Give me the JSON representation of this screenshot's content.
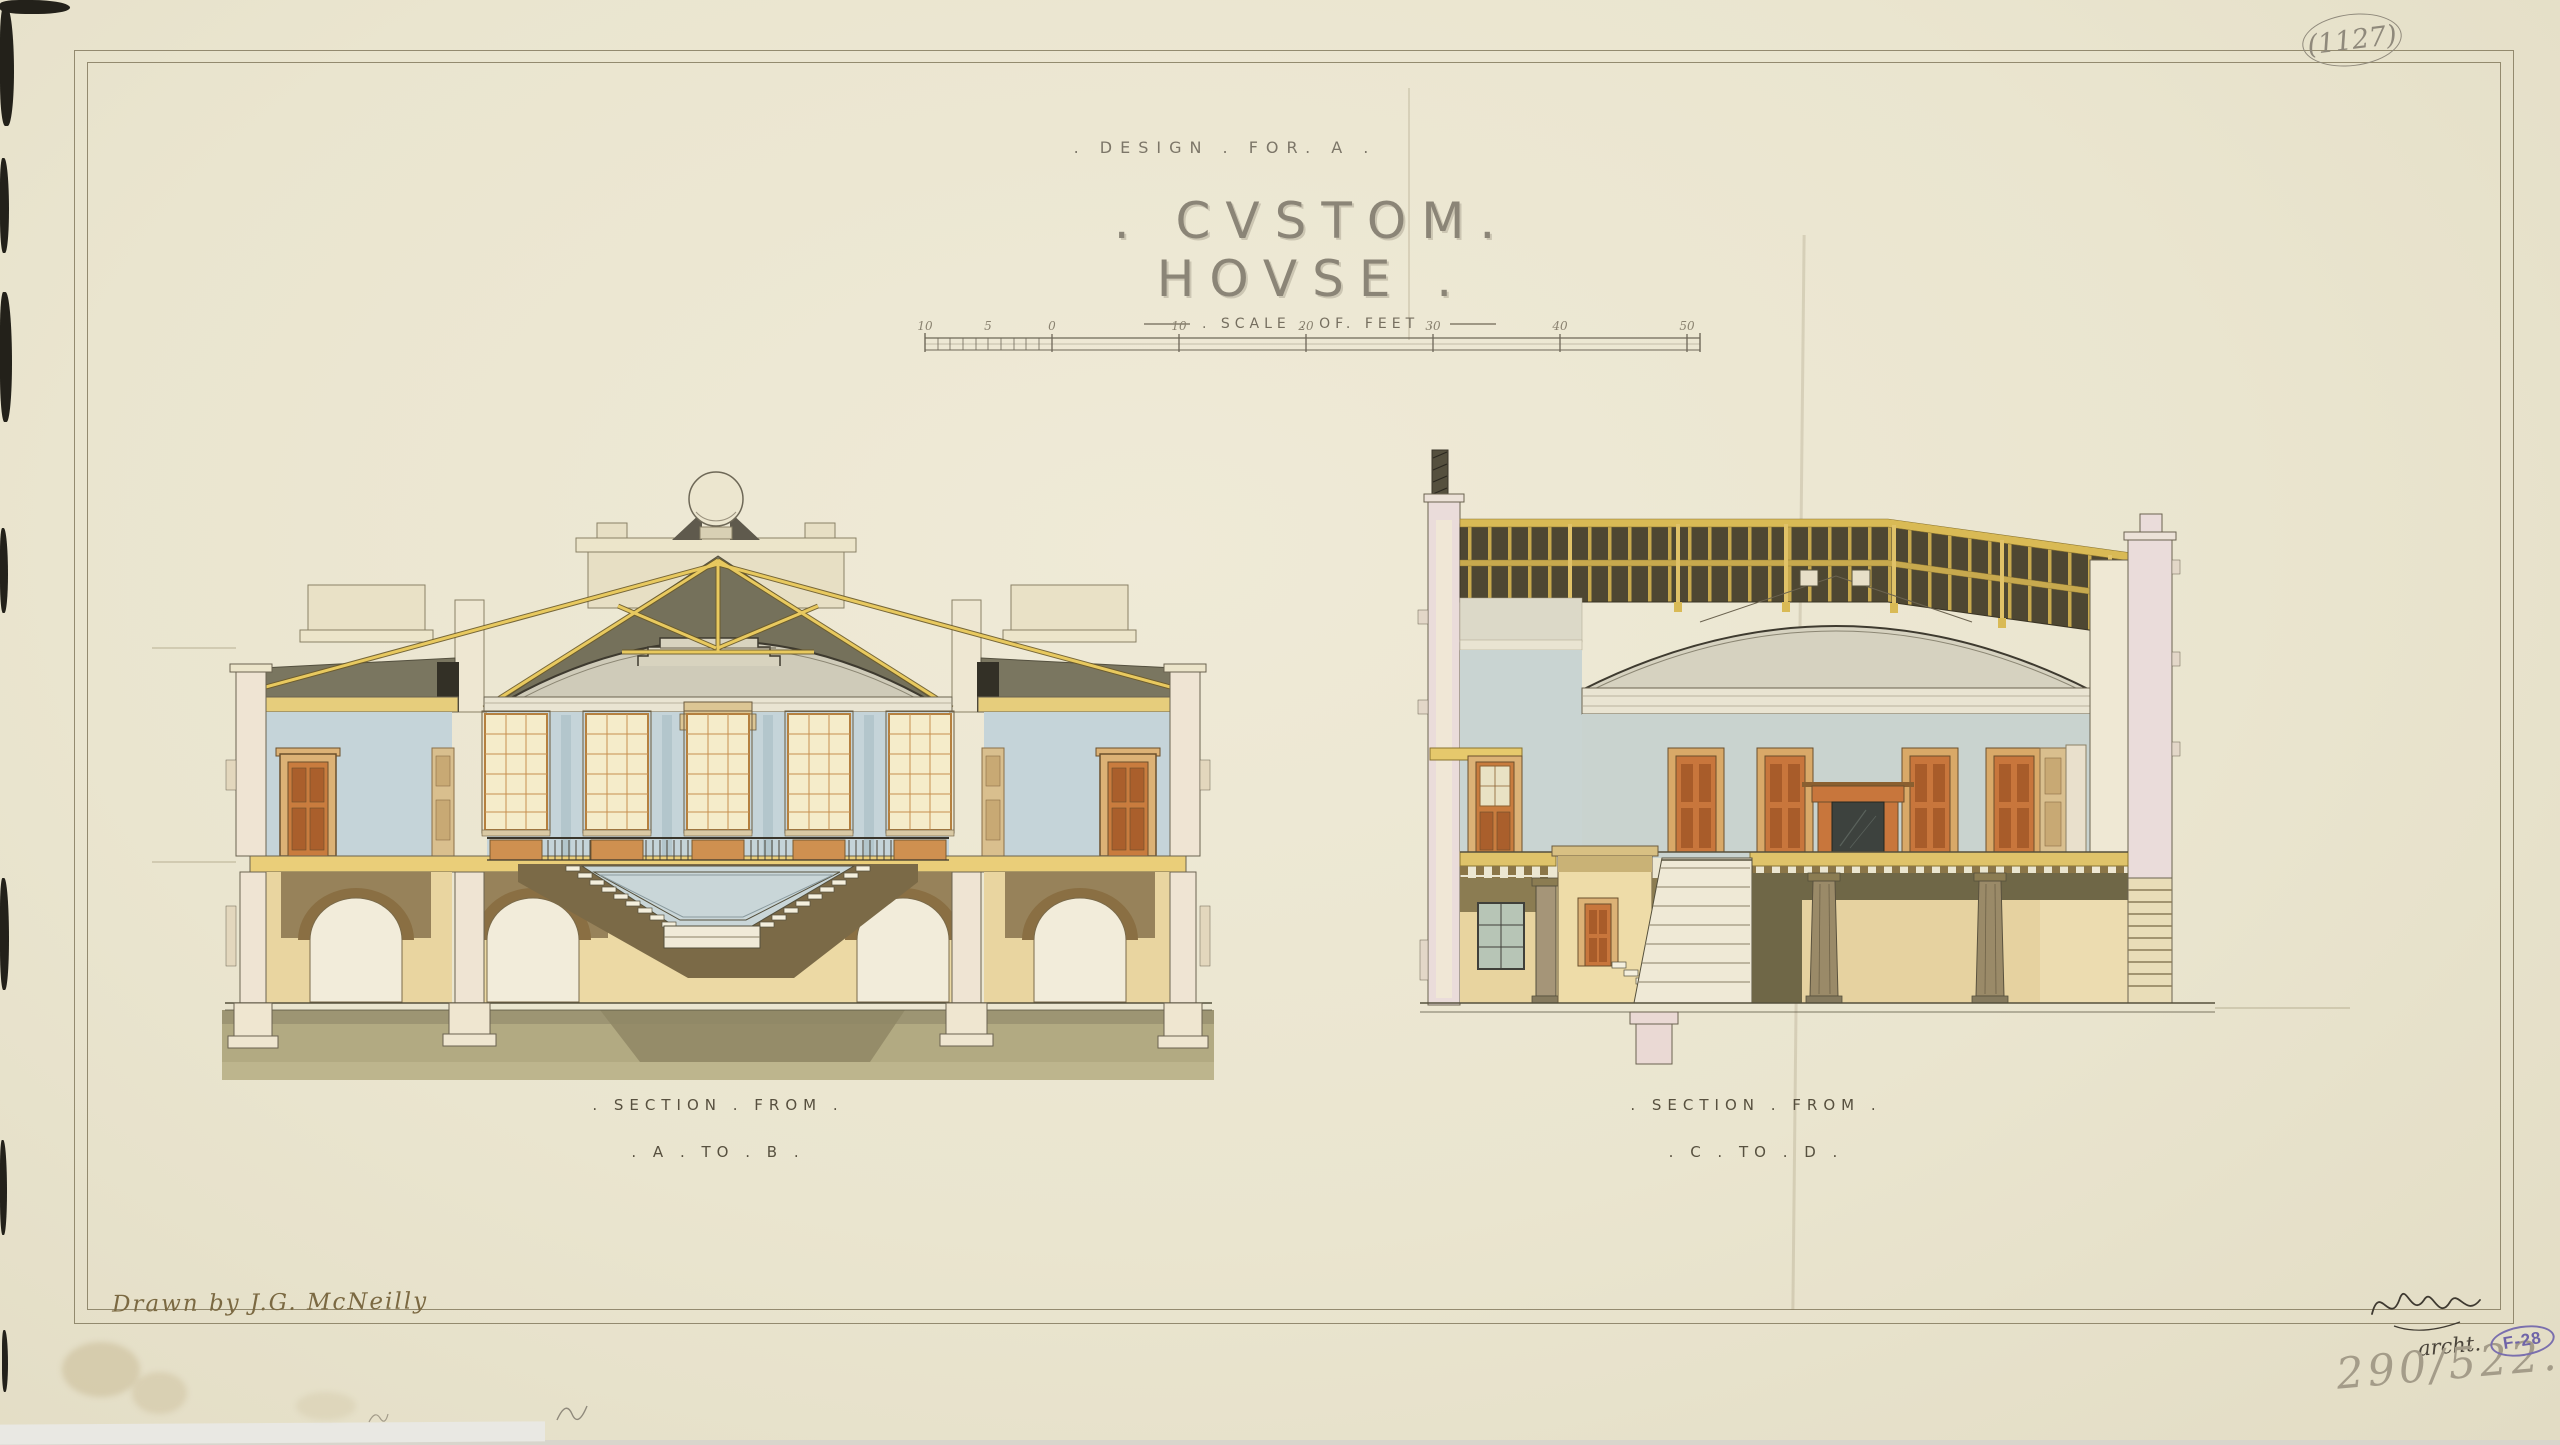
{
  "title": {
    "subtitle": ". DESIGN . FOR. A .",
    "main": ". CVSTOM. HOVSE ."
  },
  "scale_bar": {
    "label": ". SCALE . OF. FEET .",
    "ticks": [
      "10",
      "5",
      "0",
      "10",
      "20",
      "30",
      "40",
      "50"
    ]
  },
  "sections": [
    {
      "id": "ab",
      "caption_line1": ". SECTION . FROM .",
      "caption_line2": ". A . TO . B ."
    },
    {
      "id": "cd",
      "caption_line1": ". SECTION . FROM .",
      "caption_line2": ". C . TO . D ."
    }
  ],
  "annotations": {
    "archive_number": "(1127)",
    "drawn_by": "Drawn by J.G. McNeilly",
    "signature_title": "archt.",
    "catalog_number": "290/522.",
    "stamp": "F-28"
  },
  "palette": {
    "paper": "#eae5cf",
    "ink": "#57503f",
    "pencil": "#8f897b",
    "stamp_purple": "#7a6fae",
    "wash_blue": "#c5d4d9",
    "wash_tan": "#ecd9a4",
    "wash_olive": "#b2aa82",
    "truss_gold": "#e8c95f",
    "door_orange": "#c8763c",
    "roof_grey": "#75715b",
    "pink_wall": "#eadcda",
    "skylight_dark": "#4e4732"
  }
}
